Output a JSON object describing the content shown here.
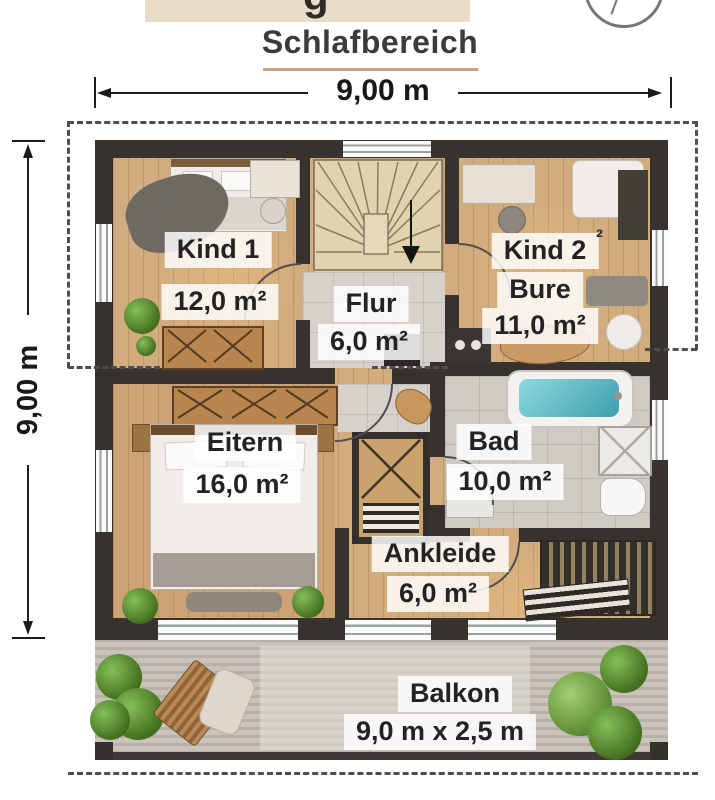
{
  "header": {
    "clipped_title_fragment": "g",
    "subtitle": "Schlafbereich"
  },
  "icons": {
    "compass": "compass-rose-partial-circle",
    "stairs_direction": "down-arrow"
  },
  "dimensions": {
    "width_label": "9,00 m",
    "height_label": "9,00 m"
  },
  "rooms": {
    "kind1": {
      "name": "Kind 1",
      "area": "12,0 m²"
    },
    "kind2": {
      "name": "Kind 2",
      "artifact": "²",
      "extra_label": "Bure",
      "area": "11,0 m²"
    },
    "flur": {
      "name": "Flur",
      "area": "6,0 m²"
    },
    "eltern": {
      "name": "Eitern",
      "area": "16,0 m²"
    },
    "bad": {
      "name": "Bad",
      "area": "10,0 m²"
    },
    "ankleide": {
      "name": "Ankleide",
      "area": "6,0 m²"
    },
    "balkon": {
      "name": "Balkon",
      "area": "9,0 m x 2,5 m"
    }
  },
  "colors": {
    "wall": "#37322d",
    "wood_floor": "#d2ac7e",
    "tile_floor": "#d6d2cb",
    "title_underline": "#c9a183",
    "bath_water": "#4fb3bf",
    "label_background": "rgba(255,255,255,0.84)",
    "dashed_line": "#4e4e4e"
  }
}
